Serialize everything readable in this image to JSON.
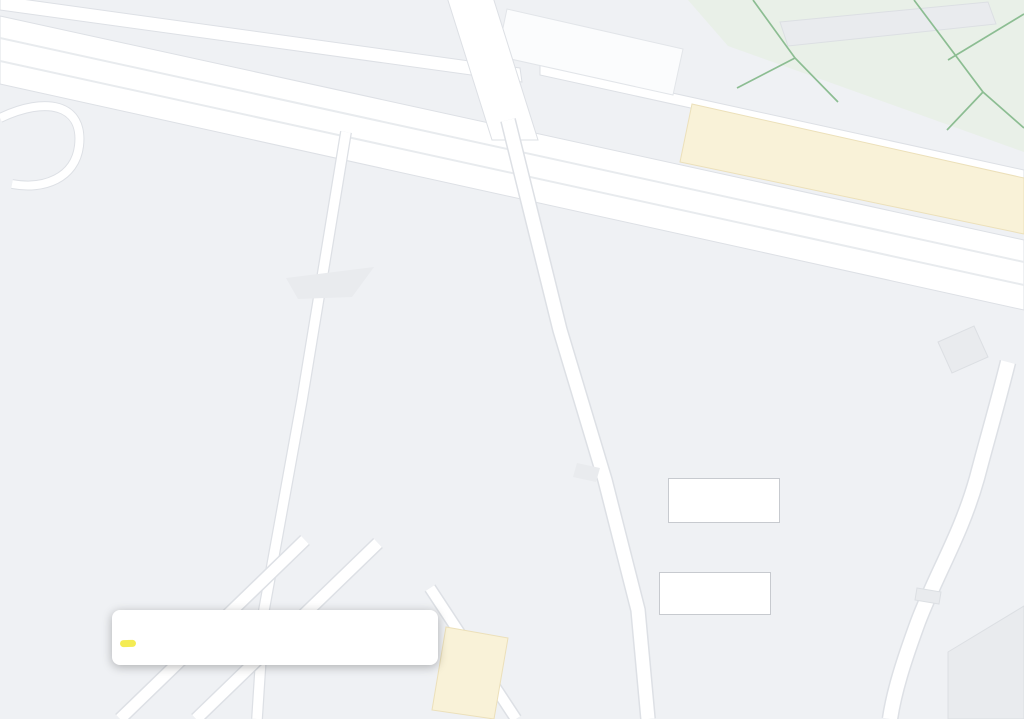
{
  "map": {
    "street_labels": [
      {
        "text": "Lubelska",
        "x": 470,
        "y": 46,
        "rot": -72
      },
      {
        "text": "Gwiezdna",
        "x": 960,
        "y": 587,
        "rot": -52
      },
      {
        "text": "na",
        "x": 908,
        "y": 705,
        "rot": -62
      }
    ],
    "pois": [
      {
        "name": "Parking",
        "x": 322,
        "y": 1,
        "align": "left",
        "cls": "c-blue"
      },
      {
        "name": "Parking",
        "icon": "icon-p",
        "x": 598,
        "y": 57,
        "lx": 0,
        "ly": -27,
        "align": "center",
        "cls": "c-blue"
      },
      {
        "name": "Targ",
        "icon": "icon-cart",
        "x": 719,
        "y": 77,
        "lx": 7,
        "ly": 15,
        "align": "center",
        "cls": "c-blue"
      },
      {
        "name": "Wędliny swojskie",
        "sub": "Sklep z wędlinami",
        "icon": "icon-bag",
        "x": 875,
        "y": 133,
        "lx": -16,
        "ly": -11,
        "align": "right",
        "cls": "c-blue"
      },
      {
        "name": "Samo Zdrowie Warzywa",
        "name2": "U Bartka i Marzenki",
        "sub": "Sklep z owocami i warzywami",
        "icon": "icon-bag",
        "x": 892,
        "y": 170,
        "lx": -16,
        "ly": -18,
        "align": "right",
        "cls": "c-blue"
      },
      {
        "name": "Bankomat",
        "icon": "icon-atm",
        "x": 983,
        "y": 200,
        "lx": 40,
        "ly": -23,
        "align": "right",
        "cls": "c-blue"
      },
      {
        "name": "Parking Plac Papieski",
        "icon": "icon-p",
        "x": 398,
        "y": 200,
        "lx": 14,
        "ly": -7,
        "align": "left",
        "cls": "c-blue"
      },
      {
        "name": "Plac Papieski",
        "icon": "icon-camera",
        "x": 362,
        "y": 287,
        "lx": 16,
        "ly": -20,
        "align": "center",
        "cls": "c-teal"
      },
      {
        "name": "Kompleks Parku",
        "name2": "Zagórskiego",
        "icon": "icon-tree",
        "x": 755,
        "y": 452,
        "lx": 13,
        "ly": -9,
        "align": "left",
        "cls": "c-green"
      },
      {
        "name": "Plac zabaw",
        "x": 5,
        "y": 497,
        "align": "left",
        "cls": "c-green",
        "fs": 13.5
      },
      {
        "icon": "icon-tree",
        "x": 167,
        "y": 430
      },
      {
        "name": "Bartosz Malec",
        "name2": "Auto-Serwis",
        "icon": "icon-dot",
        "x": 482,
        "y": 592,
        "lx": -14,
        "ly": -12,
        "align": "right",
        "cls": "c-navy"
      },
      {
        "name": "Parking",
        "icon": "icon-p",
        "x": 240,
        "y": 602,
        "lx": 15,
        "ly": -6,
        "align": "left",
        "cls": "c-blue"
      },
      {
        "name": "GOK-ART",
        "icon": "icon-dot-gray",
        "x": 1002,
        "y": 645,
        "lx": -36,
        "ly": -26,
        "align": "left",
        "cls": "c-gray"
      },
      {
        "name": "ka",
        "icon": "icon-dot-blue",
        "x": 436,
        "y": 710,
        "lx": -8,
        "ly": -30,
        "align": "left",
        "cls": "c-blue"
      },
      {
        "name": "Pa",
        "x": 1009,
        "y": 403,
        "align": "left",
        "cls": "c-blue"
      },
      {
        "icon": "icon-bus",
        "x": 903,
        "y": 275
      }
    ],
    "distance_markers": [
      {
        "text": "100,00 m",
        "x": 581,
        "y": 510,
        "rot": -80
      },
      {
        "text": "200,00 m",
        "x": 464,
        "y": 439,
        "rot": -73
      },
      {
        "text": "300,00 m",
        "x": 294,
        "y": 508,
        "rot": 15
      },
      {
        "text": "400,00 m",
        "x": 116,
        "y": 412,
        "rot": -71
      },
      {
        "text": "500,00 m",
        "x": 58,
        "y": 185,
        "rot": 71
      },
      {
        "text": "600,00 m",
        "x": 197,
        "y": 92,
        "rot": 16
      },
      {
        "text": "700,00 m",
        "x": 463,
        "y": 172,
        "rot": 16
      },
      {
        "text": "800,00 m",
        "x": 727,
        "y": 246,
        "rot": 16
      },
      {
        "text": "900,00 m",
        "x": 928,
        "y": 318,
        "rot": -41
      }
    ],
    "arrows": [
      {
        "x": 22,
        "y": 2,
        "rot": 200
      },
      {
        "x": 427,
        "y": 77,
        "rot": 180
      },
      {
        "x": 531,
        "y": 151,
        "rot": 12
      },
      {
        "x": 913,
        "y": 222,
        "rot": 185
      }
    ],
    "overlays": {
      "start_meta": {
        "text": "START/META"
      },
      "race_office": {
        "text": "BIURO ZAWODÓW"
      }
    },
    "attribution": [
      {
        "text": "Dane mapy ©2022 Google",
        "x": 797,
        "y": 710
      },
      {
        "text": "Polska",
        "x": 938,
        "y": 710
      },
      {
        "text": "Wszystk",
        "x": 976,
        "y": 710
      }
    ]
  },
  "route": {
    "stroke": "#1b1b1b",
    "closed": true,
    "tick_spacing": 26,
    "points": [
      [
        751,
        481
      ],
      [
        627,
        577
      ],
      [
        565,
        539
      ],
      [
        580,
        451
      ],
      [
        587,
        407
      ],
      [
        503,
        390
      ],
      [
        468,
        473
      ],
      [
        439,
        537
      ],
      [
        421,
        539
      ],
      [
        406,
        551
      ],
      [
        110,
        470
      ],
      [
        106,
        452
      ],
      [
        89,
        441
      ],
      [
        128,
        350
      ],
      [
        27,
        157
      ],
      [
        95,
        112
      ],
      [
        127,
        63
      ],
      [
        930,
        295
      ],
      [
        966,
        307
      ]
    ],
    "extra_vertices": [
      [
        743,
        477
      ]
    ],
    "start_ellipse": {
      "x": 732,
      "y": 470,
      "rot": -35
    }
  },
  "measure_popup": {
    "title": "Zmierz odległość",
    "hint": "Kliknij na mapie, by wydłużyć ścieżkę",
    "area_line": "Łączna powierzchnia: 39 825,33 m² (428 676,30 ft²)",
    "distance_line": "Całkowity dystans: 994,70 m (3 263,45 stóp)",
    "close_icon": "✕"
  }
}
